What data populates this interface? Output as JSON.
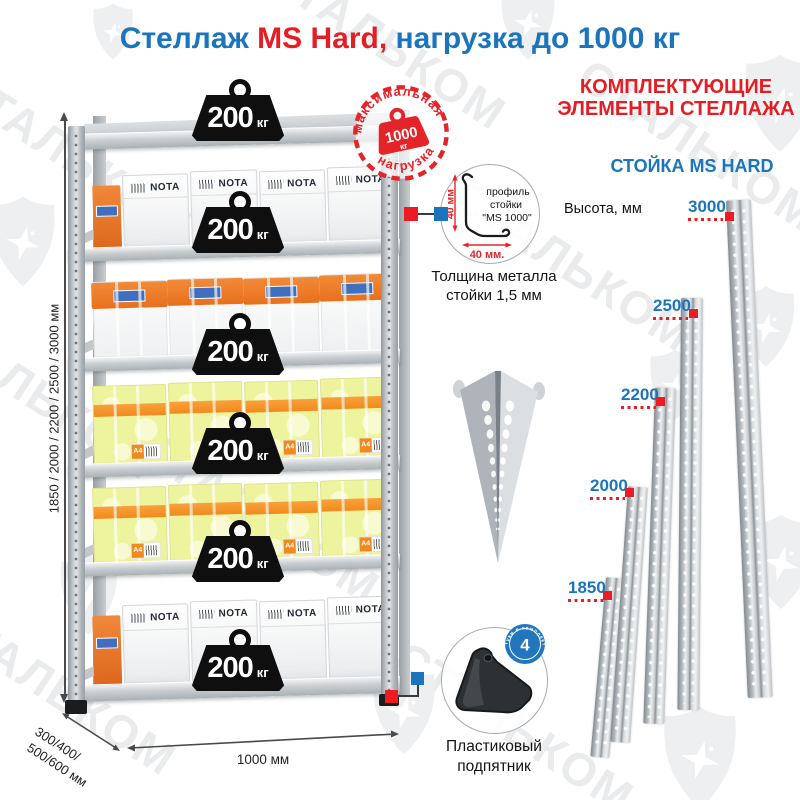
{
  "header": {
    "title_blue1": "Стеллаж ",
    "title_red": "MS Hard,",
    "title_blue2": " нагрузка до 1000 кг"
  },
  "watermark": {
    "brand": "СТАЛЬКОМ"
  },
  "colors": {
    "blue": "#1b75bc",
    "red": "#e31e24",
    "stamp_red": "#e5242a"
  },
  "rack": {
    "box_brand": "NOTA",
    "paper_label": "A4",
    "weights": [
      {
        "value": "200",
        "unit": "кг"
      },
      {
        "value": "200",
        "unit": "кг"
      },
      {
        "value": "200",
        "unit": "кг"
      },
      {
        "value": "200",
        "unit": "кг"
      },
      {
        "value": "200",
        "unit": "кг"
      },
      {
        "value": "200",
        "unit": "кг"
      }
    ],
    "stamp": {
      "arc_top": "максимальная",
      "arc_bottom": "нагрузка",
      "value": "1000",
      "unit": "кг"
    },
    "dimensions": {
      "height": "1850 / 2000 / 2200 / 2500 / 3000 мм",
      "depth_line1": "300/400/",
      "depth_line2": "500/600 мм",
      "width": "1000 мм"
    }
  },
  "components": {
    "profile": {
      "text_line1": "профиль",
      "text_line2": "стойки",
      "text_line3": "\"MS 1000\"",
      "dim_vertical": "40 мм",
      "dim_horizontal": "40 мм."
    },
    "thickness_line1": "Толщина металла",
    "thickness_line2": "стойки 1,5 мм",
    "foot": {
      "label_line1": "Пластиковый",
      "label_line2": "подпятник",
      "badge_count": "4",
      "badge_caption": "штуки в комплекте"
    }
  },
  "right_panel": {
    "heading_line1": "КОМПЛЕКТУЮЩИЕ",
    "heading_line2": "ЭЛЕМЕНТЫ СТЕЛЛАЖА",
    "subheading": "СТОЙКА MS HARD",
    "height_label": "Высота, мм",
    "posts": [
      {
        "height": "1850"
      },
      {
        "height": "2000"
      },
      {
        "height": "2200"
      },
      {
        "height": "2500"
      },
      {
        "height": "3000"
      }
    ]
  }
}
